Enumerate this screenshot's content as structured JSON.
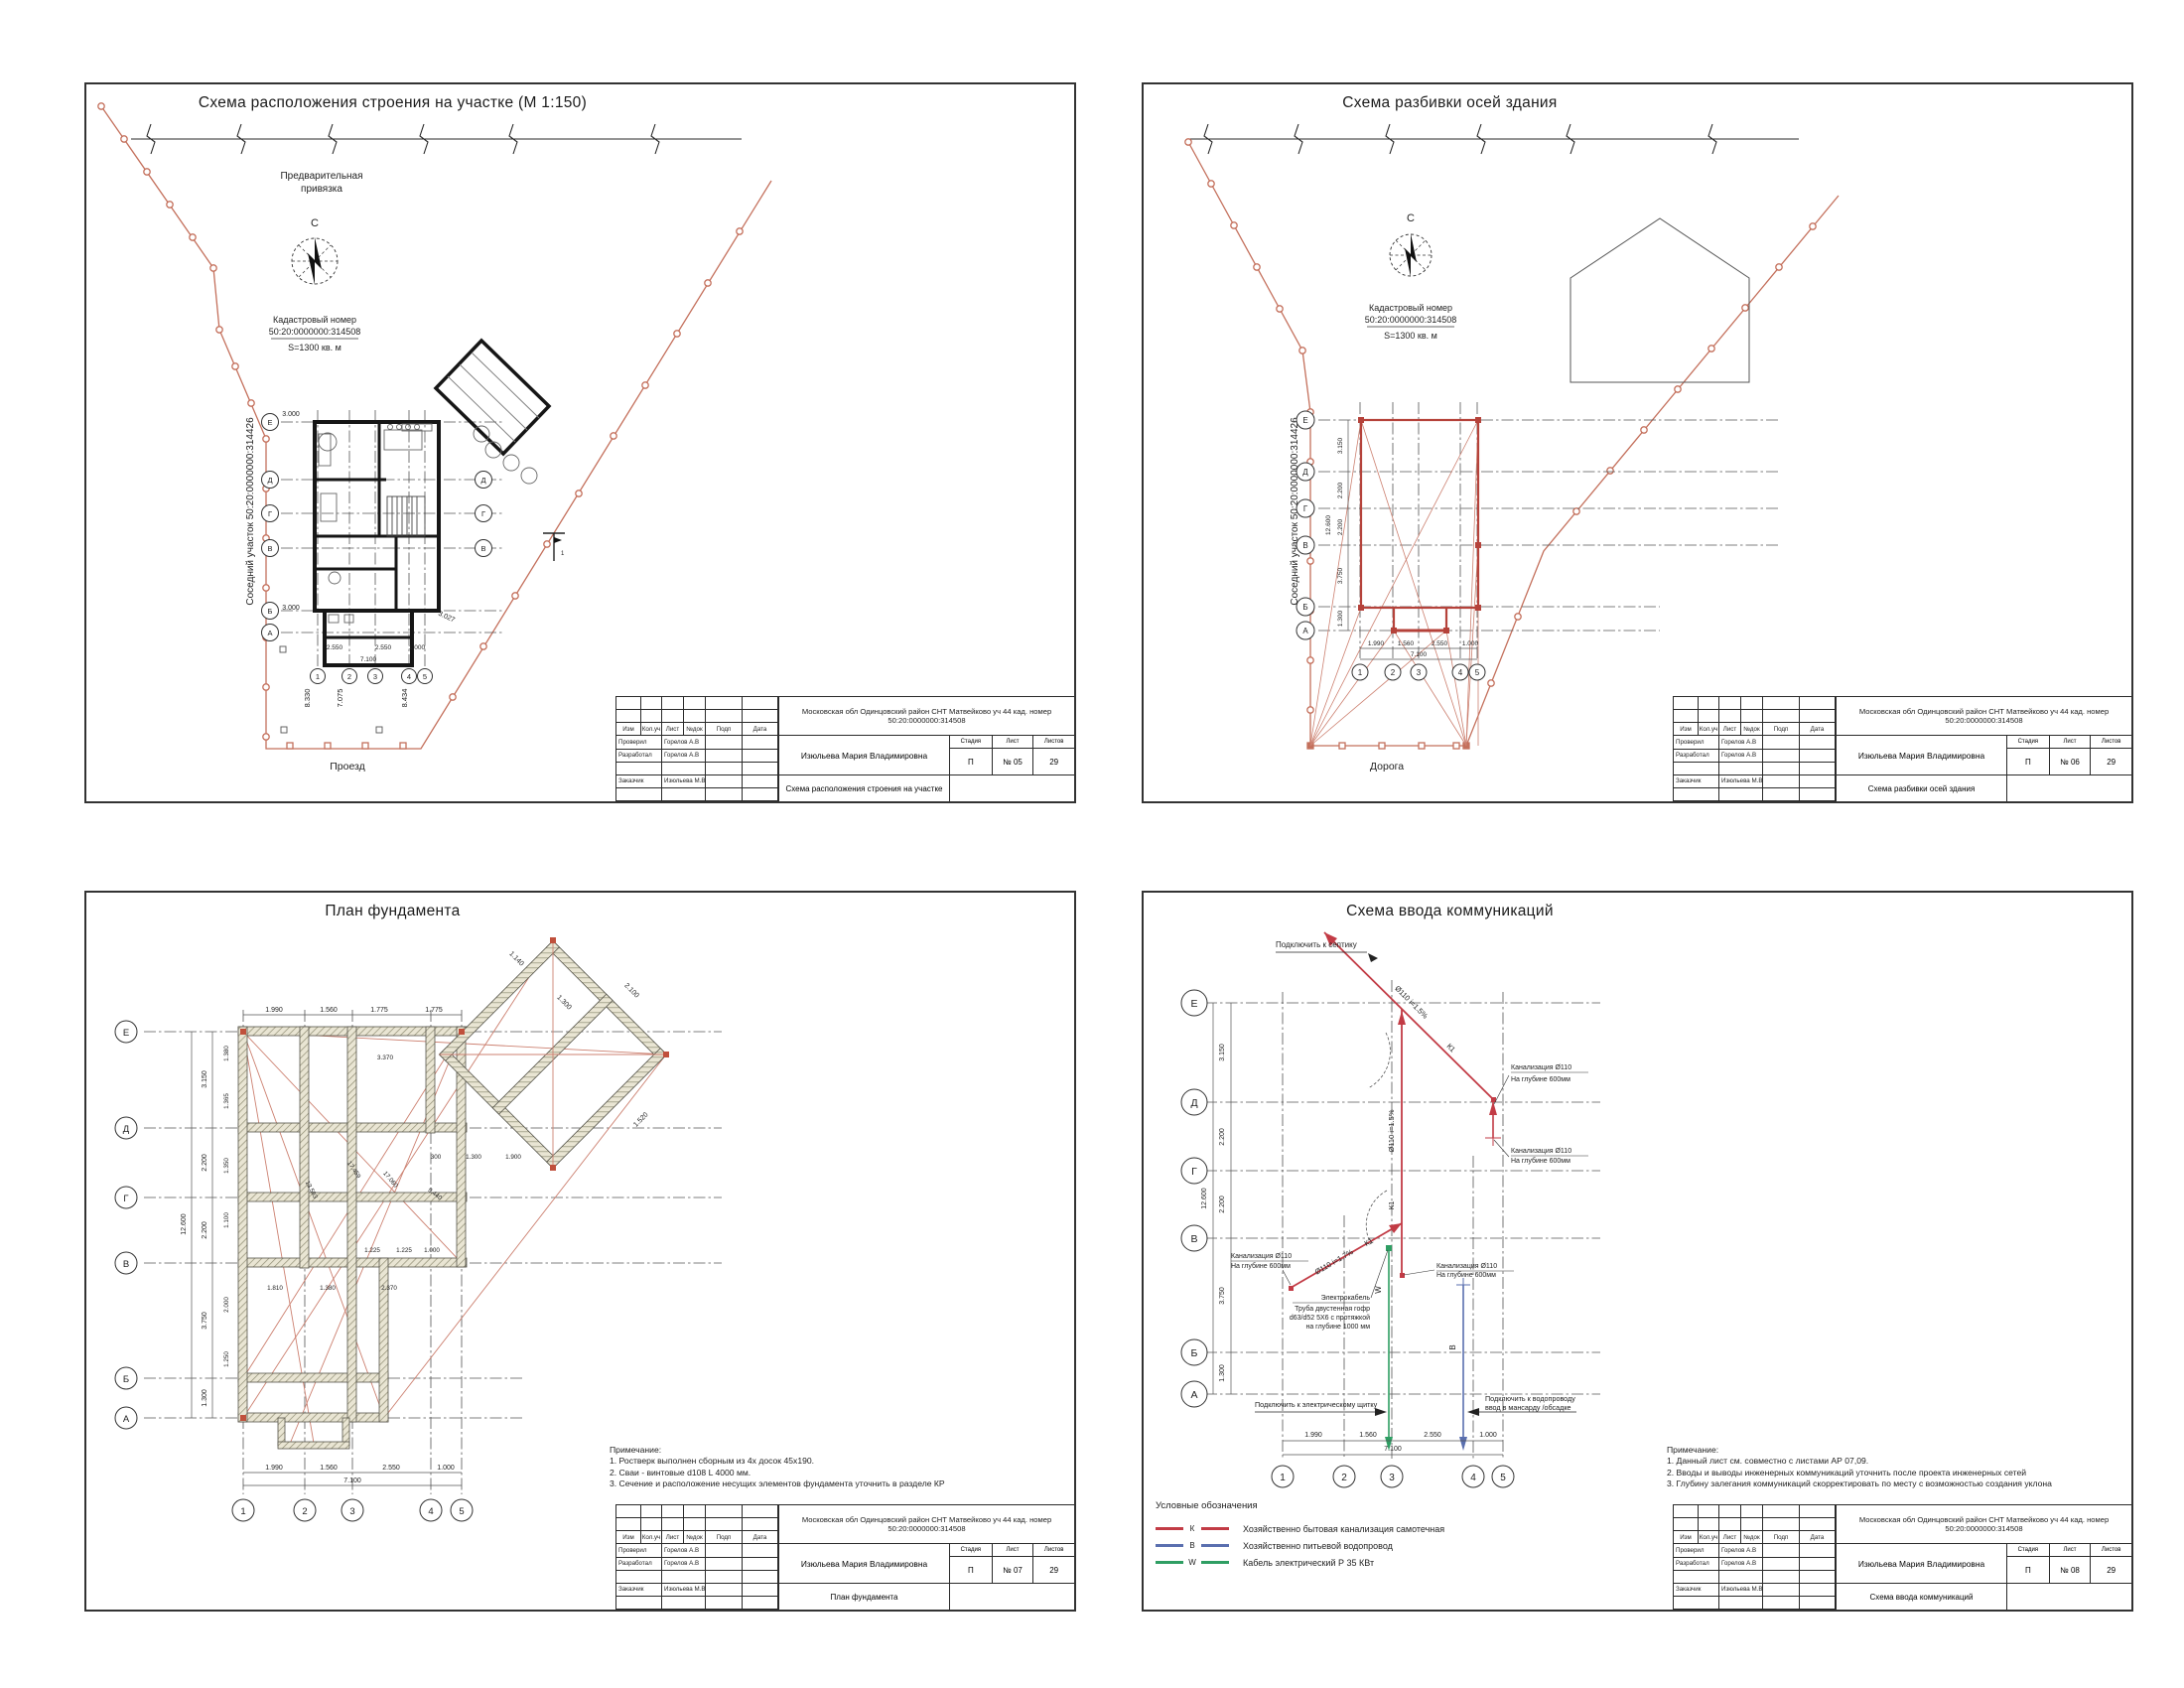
{
  "colors": {
    "boundary": "#c4705c",
    "building_outline_red": "#b5423a",
    "sewer_red": "#c23b45",
    "water_blue": "#5a6faf",
    "cable_green": "#2f9e63",
    "hatch_fill": "#e9e5d3"
  },
  "common": {
    "north": "С",
    "cadastral_label": "Кадастровый номер",
    "cadastral_number": "50:20:0000000:314508",
    "area": "S=1300 кв. м",
    "neighbor": "Соседний участок 50:20:0000000:314426",
    "axes_left": [
      "Е",
      "Д",
      "Г",
      "В",
      "Б",
      "А"
    ],
    "axes_bottom": [
      "1",
      "2",
      "3",
      "4",
      "5"
    ],
    "stamp": {
      "address": "Московская обл Одинцовский район СНТ Матвейково уч 44 кад. номер 50:20:0000000:314508",
      "client_name": "Изюльева Мария Владимировна",
      "cols": [
        "Изм",
        "Кол.уч",
        "Лист",
        "№док",
        "Подп",
        "Дата"
      ],
      "checked_label": "Проверил",
      "checked_name": "Горелов А.В",
      "developed_label": "Разработал",
      "developed_name": "Горелов А.В",
      "customer_label": "Заказчик",
      "customer_name": "Изюльева М.В",
      "stage_label": "Стадия",
      "sheet_label": "Лист",
      "sheets_label": "Листов",
      "stage": "П",
      "total_sheets": "29"
    }
  },
  "sheet1": {
    "title": "Схема расположения строения на участке (М 1:150)",
    "stamp_title": "Схема расположения строения на участке",
    "sheet_no": "№ 05",
    "prelim_1": "Предварительная",
    "prelim_2": "привязка",
    "road": "Проезд",
    "site_dims": [
      "8.330",
      "7.075",
      "8.434"
    ],
    "dim_3000": "3.000",
    "plan_dims": [
      "2.550",
      "2.550",
      "1.000"
    ],
    "plan_total": "7.100",
    "diag_dim": "3.027",
    "benchmark": "1"
  },
  "sheet2": {
    "title": "Схема разбивки осей здания",
    "stamp_title": "Схема разбивки осей здания",
    "sheet_no": "№ 06",
    "road": "Дорога",
    "dims_left": [
      "3.150",
      "2.200",
      "2.200",
      "3.750",
      "1.300"
    ],
    "total_left": "12.600",
    "dims_bottom": [
      "1.990",
      "1.560",
      "2.550",
      "1.000"
    ],
    "total_bottom": "7.100"
  },
  "sheet3": {
    "title": "План фундамента",
    "stamp_title": "План фундамента",
    "sheet_no": "№ 07",
    "notes": [
      "Примечание:",
      "1. Ростверк выполнен сборным из 4х досок 45х190.",
      "2. Сваи - винтовые d108 L 4000 мм.",
      "3. Сечение и расположение несущих элементов фундамента уточнить в разделе КР"
    ],
    "dims_top": [
      "1.990",
      "1.560",
      "1.775",
      "1.775"
    ],
    "dims_left": [
      "3.150",
      "2.200",
      "2.200",
      "3.750",
      "1.300"
    ],
    "total_left": "12.600",
    "sub_dims_left": [
      "1.380",
      "1.365",
      "1.350",
      "1.100",
      "2.000",
      "1.250"
    ],
    "dims_bottom": [
      "1.990",
      "1.560",
      "2.550",
      "1.000"
    ],
    "total_bottom": "7.100",
    "inner_dims": [
      "3.370",
      "1.225",
      "1.225",
      "1.000",
      "1.810",
      "1.380",
      "2.370"
    ],
    "wing_dims": [
      "2.100",
      "1.140",
      "1.300",
      "1.520"
    ],
    "wing_dims2": [
      "300",
      "1.300",
      "1.900"
    ],
    "diag_dims": [
      "13.593",
      "17.459",
      "17.060",
      "9.440"
    ]
  },
  "sheet4": {
    "title": "Схема ввода коммуникаций",
    "stamp_title": "Схема ввода коммуникаций",
    "sheet_no": "№ 08",
    "septic": "Подключить к септику",
    "k_pipe": "Ø110 i=1.5%",
    "k_pipe2": "Ø110 i=1.7%",
    "k1": "К1",
    "w": "W",
    "b": "В",
    "sewer_callout_1": "Канализация Ø110",
    "sewer_callout_2": "На глубине 600мм",
    "cable_lines": [
      "Электрокабель",
      "Труба двустенная гофр",
      "d63/d52 5Х6 с протяжкой",
      "на глубине 1000 мм"
    ],
    "electric": "Подключить к электрическому щитку",
    "water_1": "Подключить к водопроводу",
    "water_2": "ввод в мансарду /обсадке",
    "legend_title": "Условные обозначения",
    "legend": [
      {
        "sym": "К",
        "text": "Хозяйственно бытовая канализация самотечная"
      },
      {
        "sym": "В",
        "text": "Хозяйственно питьевой водопровод"
      },
      {
        "sym": "W",
        "text": "Кабель электрический Р 35 КВт"
      }
    ],
    "notes": [
      "Примечание:",
      "1. Данный лист см. совместно с листами АР 07,09.",
      "2. Вводы и выводы инженерных коммуникаций уточнить после проекта инженерных сетей",
      "3. Глубину залегания коммуникаций скорректировать по месту с возможностью создания уклона"
    ],
    "dims_left": [
      "3.150",
      "2.200",
      "2.200",
      "3.750",
      "1.300"
    ],
    "total_left": "12.600",
    "dims_bottom": [
      "1.990",
      "1.560",
      "2.550",
      "1.000"
    ],
    "total_bottom": "7.100"
  }
}
